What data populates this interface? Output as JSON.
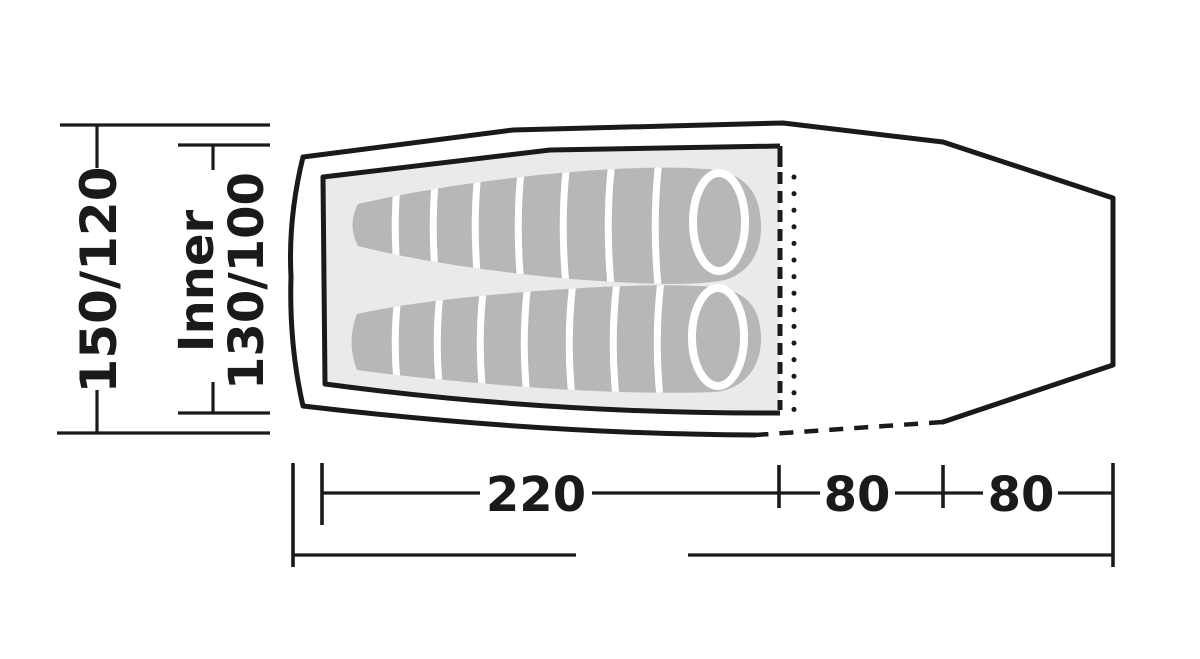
{
  "figure": {
    "type": "tent-floorplan-top-view",
    "vertical_dimensions": {
      "outer_width": "150/120",
      "inner_label": "Inner",
      "inner_width": "130/100"
    },
    "horizontal_dimensions": {
      "inner_length": "220",
      "porch_depth": "80",
      "rear_depth": "80",
      "total_length": "395"
    },
    "colors": {
      "outline": "#1a1a1a",
      "tent_fill": "#ffffff",
      "inner_floor": "#e9ebea",
      "sleeping_bag": "#b5b8b6",
      "stripe": "#ffffff",
      "background": "#ffffff"
    }
  }
}
